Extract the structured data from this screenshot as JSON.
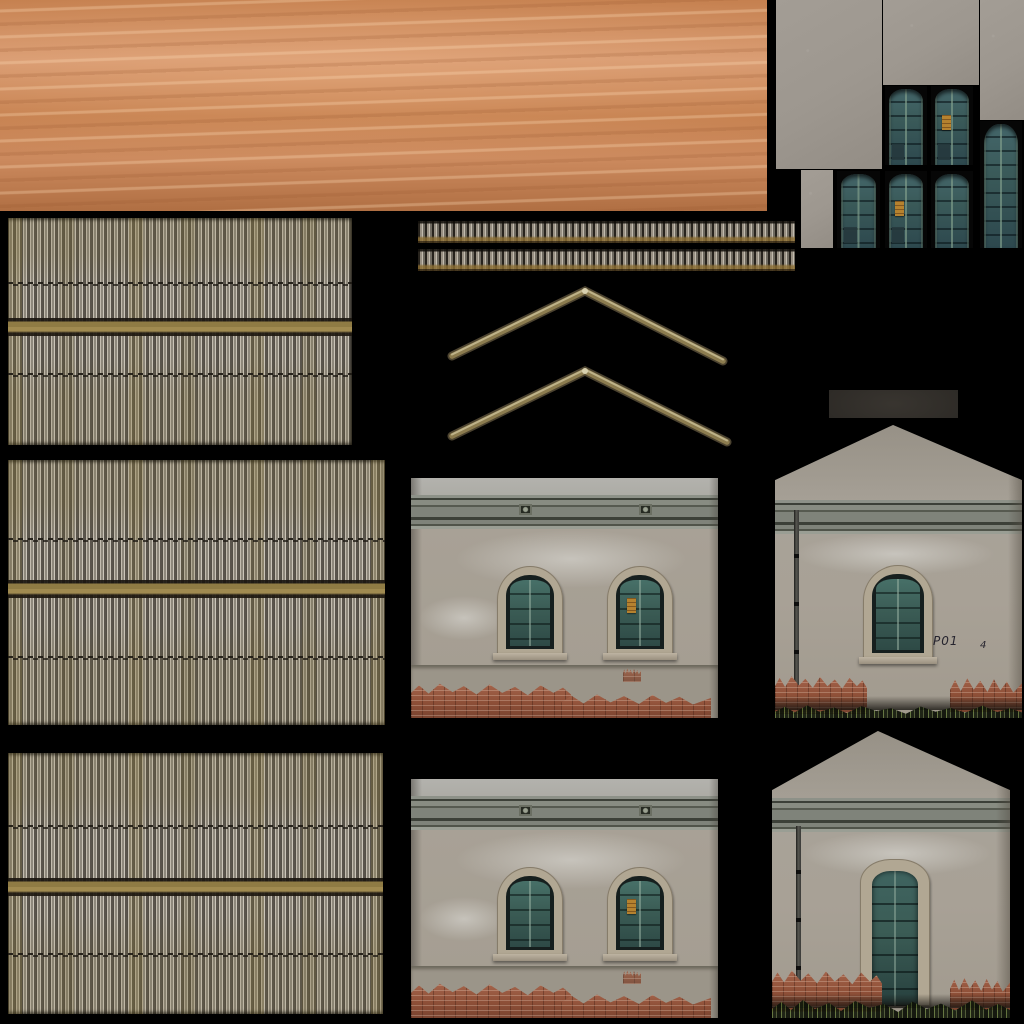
{
  "atlas": {
    "kind": "building texture atlas",
    "background": "#000000",
    "width": 1024,
    "height": 1024
  },
  "graffiti": {
    "text": "P01",
    "mark": "4"
  },
  "palette": {
    "black_background": "#000000",
    "dirt_base": "#c5804f",
    "dirt_light": "#d89b72",
    "dirt_dark": "#b06f43",
    "roof_rib_light": "#c6bfb2",
    "roof_rib_mid": "#8e887c",
    "roof_rib_dark": "#57524a",
    "roof_seam_ochre": "#8f7b44",
    "roof_line_dark": "#241f18",
    "roof_moss_ochre": "#8a7636",
    "stucco_gray": "#9d978f",
    "wall_top_light": "#b3b2ad",
    "wall_base": "#a8a196",
    "cornice_dark": "#3c4038",
    "cornice_mid": "#7f837a",
    "stone_frame": "#b1a793",
    "shutter_teal": "#3b5c55",
    "shutter_dark": "#26383d",
    "window_void": "#161f1e",
    "brick_red": "#8f5038",
    "brick_light": "#a96950",
    "plinth_gray": "#9b9589",
    "door_teal": "#3a5a59",
    "door_frame_green": "#688476",
    "poster_orange": "#b5822f",
    "chevron_light": "#c3b88f",
    "chevron_mid": "#8c7c4f",
    "chevron_dark": "#4c4330",
    "pipe_dark": "#3a3a38",
    "grass_dark": "#2c3120",
    "plate_dark": "#2d2a26",
    "graffiti_ink": "#26242e"
  },
  "tiles": [
    {
      "name": "dirt-ground-texture",
      "desc": "orange clay ground"
    },
    {
      "name": "corrugated-roof-texture-1",
      "desc": "corrugated fibre-cement sheet with ochre seam"
    },
    {
      "name": "corrugated-roof-texture-2",
      "desc": "corrugated fibre-cement sheet with ochre seam"
    },
    {
      "name": "corrugated-roof-texture-3",
      "desc": "corrugated fibre-cement sheet with ochre seam"
    },
    {
      "name": "roof-eave-strip-1",
      "desc": "thin corrugated eave strip"
    },
    {
      "name": "roof-eave-strip-2",
      "desc": "thin corrugated eave strip"
    },
    {
      "name": "roof-ridge-chevron-1",
      "desc": "angled ridge capping"
    },
    {
      "name": "roof-ridge-chevron-2",
      "desc": "angled ridge capping"
    },
    {
      "name": "stucco-patch-large",
      "desc": "plain stucco"
    },
    {
      "name": "stucco-patch-wide",
      "desc": "plain stucco"
    },
    {
      "name": "stucco-patch-tall",
      "desc": "plain stucco"
    },
    {
      "name": "stucco-patch-small",
      "desc": "plain stucco"
    },
    {
      "name": "green-door-tiles",
      "desc": "six arched weathered teal doors, two with orange posters"
    },
    {
      "name": "dark-plate",
      "desc": "dark rectangular plate"
    },
    {
      "name": "two-window-facade-1",
      "desc": "stucco wall, cornice, two arched shuttered windows, exposed brick base"
    },
    {
      "name": "two-window-facade-2",
      "desc": "stucco wall, cornice, two arched shuttered windows, exposed brick base"
    },
    {
      "name": "gable-facade-window",
      "desc": "gable end wall with arched window, downpipe, graffiti, brick base, weeds"
    },
    {
      "name": "gable-facade-door",
      "desc": "gable end wall with tall teal door, downpipe, brick base, weeds"
    }
  ]
}
